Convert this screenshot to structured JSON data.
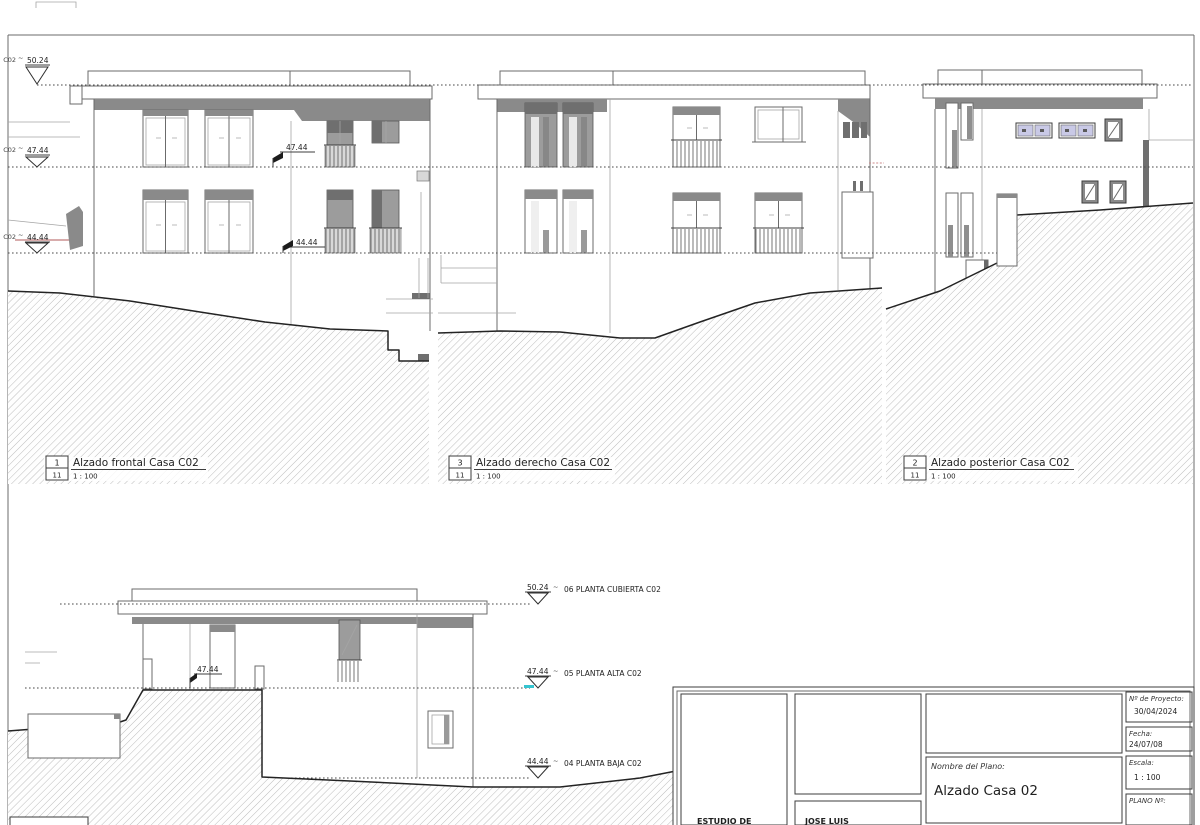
{
  "sheet": {
    "bg": "#ffffff",
    "line_color": "#6b6b6b",
    "dark_fill": "#8a8a8a",
    "hatch_color": "#adadad",
    "accent_red": "#b05a5a",
    "accent_cyan": "#35c4d0",
    "glass_lavender": "#c9c9e6"
  },
  "levels": {
    "left": [
      {
        "ref": "C02",
        "tilde": "~",
        "value": "50.24"
      },
      {
        "ref": "C02",
        "tilde": "~",
        "value": "47.44"
      },
      {
        "ref": "C02",
        "tilde": "~",
        "value": "44.44"
      }
    ],
    "spots_top": [
      {
        "value": "47.44"
      },
      {
        "value": "44.44"
      }
    ],
    "spot_bottom": {
      "value": "47.44"
    },
    "right_markers": [
      {
        "value": "50.24",
        "tilde": "~",
        "label": "06 PLANTA CUBIERTA C02"
      },
      {
        "value": "47.44",
        "tilde": "~",
        "label": "05 PLANTA ALTA C02"
      },
      {
        "value": "44.44",
        "tilde": "~",
        "label": "04 PLANTA BAJA C02"
      }
    ]
  },
  "views": [
    {
      "number": "1",
      "total": "11",
      "title": "Alzado frontal Casa C02",
      "scale": "1 : 100"
    },
    {
      "number": "3",
      "total": "11",
      "title": "Alzado derecho Casa C02",
      "scale": "1 : 100"
    },
    {
      "number": "2",
      "total": "11",
      "title": "Alzado posterior Casa C02",
      "scale": "1 : 100"
    }
  ],
  "title_block": {
    "studio": "ESTUDIO DE",
    "author": "JOSE LUIS",
    "project_no_label": "Nº de Proyecto:",
    "project_no": "30/04/2024",
    "date_label": "Fecha:",
    "date": "24/07/08",
    "plan_name_label": "Nombre del Plano:",
    "plan_name": "Alzado Casa 02",
    "scale_label": "Escala:",
    "scale": "1 : 100",
    "plan_no_label": "PLANO Nº:"
  }
}
